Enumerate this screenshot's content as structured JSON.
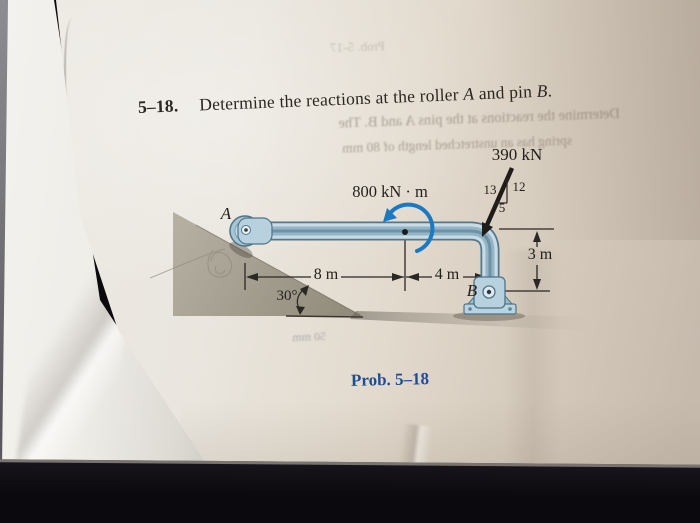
{
  "page": {
    "heading": {
      "number": "5–18.",
      "text_before_a": "Determine the reactions at the roller ",
      "label_a": "A",
      "text_between": " and pin ",
      "label_b": "B",
      "period": "."
    },
    "caption": "Prob. 5–18",
    "bleedthrough": {
      "line1": "Determine the reactions at the pins A and B. The",
      "line2": "spring has an unstretched length of 80 mm",
      "top": "Prob. 5-17",
      "left": "50 mm",
      "mid": "50 mm"
    }
  },
  "diagram": {
    "force_label": "390 kN",
    "moment_label": "800 kN · m",
    "slope_triangle": {
      "hypotenuse": "13",
      "vertical": "12",
      "horizontal": "5"
    },
    "dimensions": {
      "span_left": "8 m",
      "span_right": "4 m",
      "height": "3 m"
    },
    "incline_angle": "30°",
    "support_a_label": "A",
    "support_b_label": "B"
  },
  "colors": {
    "moment_blue": "#1b79c1",
    "beam_blue": "#a6c6d6",
    "caption_blue": "#1c4e95",
    "incline_gray": "#a49e90",
    "page_tint": "#e8e3da"
  }
}
